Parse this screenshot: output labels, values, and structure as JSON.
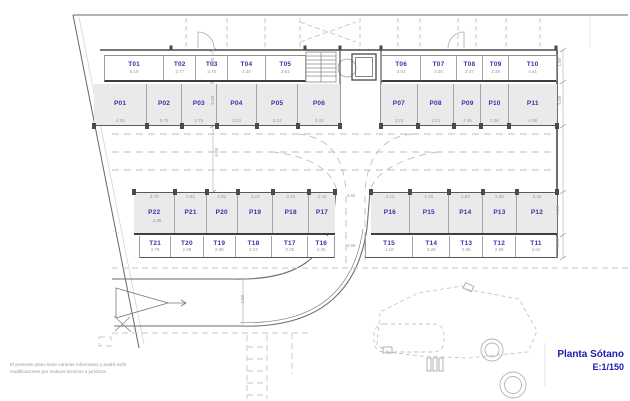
{
  "title_block": {
    "title": "Planta Sótano",
    "scale": "E:1/150"
  },
  "disclaimer": {
    "line1": "El presente plano tiene carácter informativo y podrá sufrir",
    "line2": "modificaciones por motivos técnicos o jurídicos."
  },
  "colors": {
    "label_blue": "#3434a8",
    "title_blue": "#1c1cb0",
    "stall_fill": "#eaeaea"
  },
  "stalls": {
    "top_t_left": [
      {
        "label": "T01",
        "dim": "5.19"
      },
      {
        "label": "T02",
        "dim": "2.77"
      },
      {
        "label": "T03",
        "dim": "2.76"
      },
      {
        "label": "T04",
        "dim": "3.25"
      },
      {
        "label": "T05",
        "dim": "3.51"
      }
    ],
    "top_t_right": [
      {
        "label": "T06",
        "dim": "3.61"
      },
      {
        "label": "T07",
        "dim": "3.25"
      },
      {
        "label": "T08",
        "dim": "2.37"
      },
      {
        "label": "T09",
        "dim": "2.38"
      },
      {
        "label": "T10",
        "dim": "4.41"
      }
    ],
    "top_p_left": [
      {
        "label": "P01",
        "dim": "4.25"
      },
      {
        "label": "P02",
        "dim": "2.75"
      },
      {
        "label": "P03",
        "dim": "2.75"
      },
      {
        "label": "P04",
        "dim": "3.23"
      },
      {
        "label": "P05",
        "dim": "3.23"
      },
      {
        "label": "P06",
        "dim": "3.43"
      }
    ],
    "top_p_right": [
      {
        "label": "P07",
        "dim": "3.23"
      },
      {
        "label": "P08",
        "dim": "3.23"
      },
      {
        "label": "P09",
        "dim": "2.35"
      },
      {
        "label": "P10",
        "dim": "2.36"
      },
      {
        "label": "P11",
        "dim": "4.38"
      }
    ],
    "bottom_p_left": [
      {
        "label": "P22",
        "dim": "3.78"
      },
      {
        "label": "P21",
        "dim": "2.82"
      },
      {
        "label": "P20",
        "dim": "2.82"
      },
      {
        "label": "P19",
        "dim": "3.23"
      },
      {
        "label": "P18",
        "dim": "3.23"
      },
      {
        "label": "P17",
        "dim": "2.43"
      }
    ],
    "bottom_p_right": [
      {
        "label": "P16",
        "dim": "3.23"
      },
      {
        "label": "P15",
        "dim": "3.25"
      },
      {
        "label": "P14",
        "dim": "2.83"
      },
      {
        "label": "P13",
        "dim": "2.83"
      },
      {
        "label": "P12",
        "dim": "3.42"
      }
    ],
    "bottom_t_left": [
      {
        "label": "T21",
        "dim": "2.78"
      },
      {
        "label": "T20",
        "dim": "2.88"
      },
      {
        "label": "T19",
        "dim": "2.88"
      },
      {
        "label": "T18",
        "dim": "3.23"
      },
      {
        "label": "T17",
        "dim": "3.25"
      },
      {
        "label": "T16",
        "dim": "2.35"
      }
    ],
    "bottom_t_right": [
      {
        "label": "T15",
        "dim": "4.18"
      },
      {
        "label": "T14",
        "dim": "3.28"
      },
      {
        "label": "T13",
        "dim": "2.88"
      },
      {
        "label": "T12",
        "dim": "2.88"
      },
      {
        "label": "T11",
        "dim": "3.62"
      }
    ]
  },
  "dims": {
    "trastero_depth": "1.80",
    "parking_depth": "5.08",
    "aisle_width": "6.00",
    "gap_top": "4.82",
    "gap_bottom": "4.90",
    "ramp_width": "4.00",
    "p22_inner": "2.88"
  }
}
